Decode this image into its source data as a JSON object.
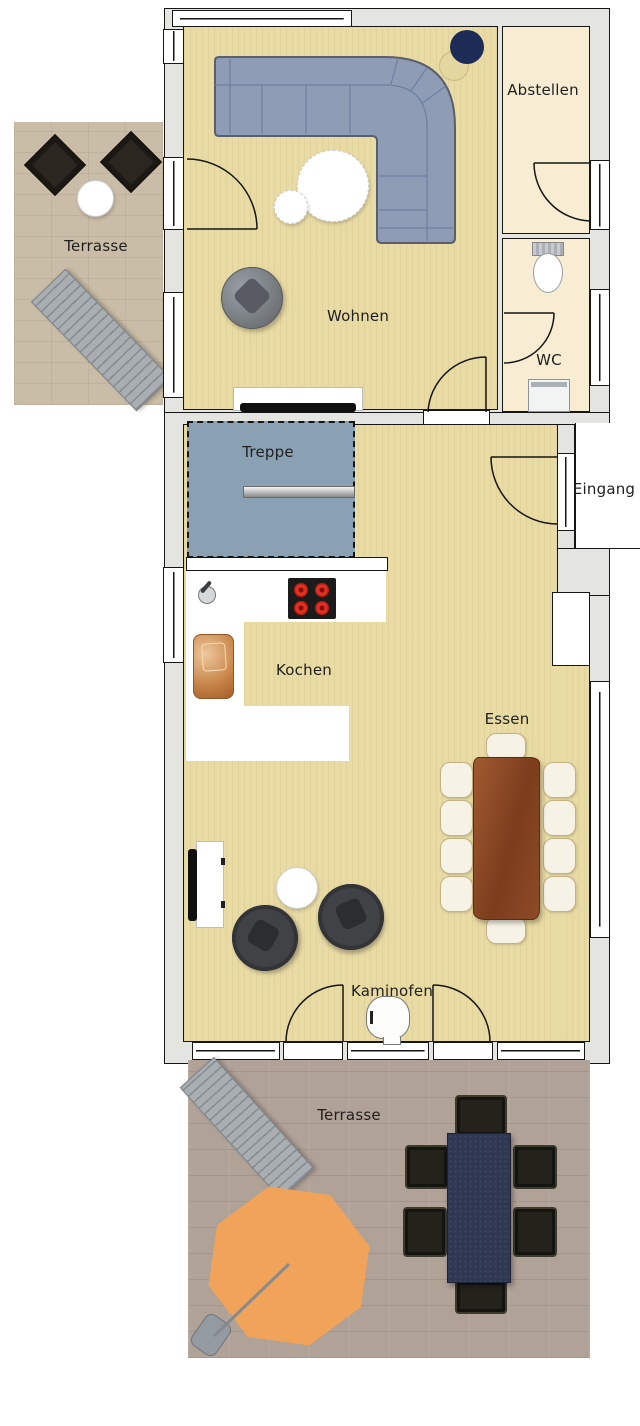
{
  "rooms": {
    "terrasse_top": {
      "label": "Terrasse"
    },
    "wohnen": {
      "label": "Wohnen"
    },
    "abstellen": {
      "label": "Abstellen"
    },
    "wc": {
      "label": "WC"
    },
    "treppe": {
      "label": "Treppe"
    },
    "eingang": {
      "label": "Eingang"
    },
    "kochen": {
      "label": "Kochen"
    },
    "essen": {
      "label": "Essen"
    },
    "kaminofen": {
      "label": "Kaminofen"
    },
    "terrasse_bottom": {
      "label": "Terrasse"
    }
  },
  "colors": {
    "wall_fill": "#e4e4e1",
    "line": "#161616",
    "floor_main": "#e9dba4",
    "floor_utility": "#f8edd3",
    "deck_top": "#cabda7",
    "deck_bottom": "#b1a298",
    "sofa_fill": "#8e9db5",
    "sofa_line": "#5a5f6e",
    "stairs": "#8aa1b3",
    "counter": "#ffffff",
    "stove": "#1b1b1b",
    "burner": "#e23222",
    "wood_table": "#8a4724",
    "chair_cream": "#f6f2e5",
    "parasol": "#f2a35a",
    "outdoor_table": "#2f3752",
    "outdoor_chair": "#23221b",
    "swivel_chair": "#404245",
    "lounger": "#a9aeb2",
    "tv": "#101010",
    "lamp_navy": "#1d2b57",
    "text": "#1f1f1f"
  }
}
